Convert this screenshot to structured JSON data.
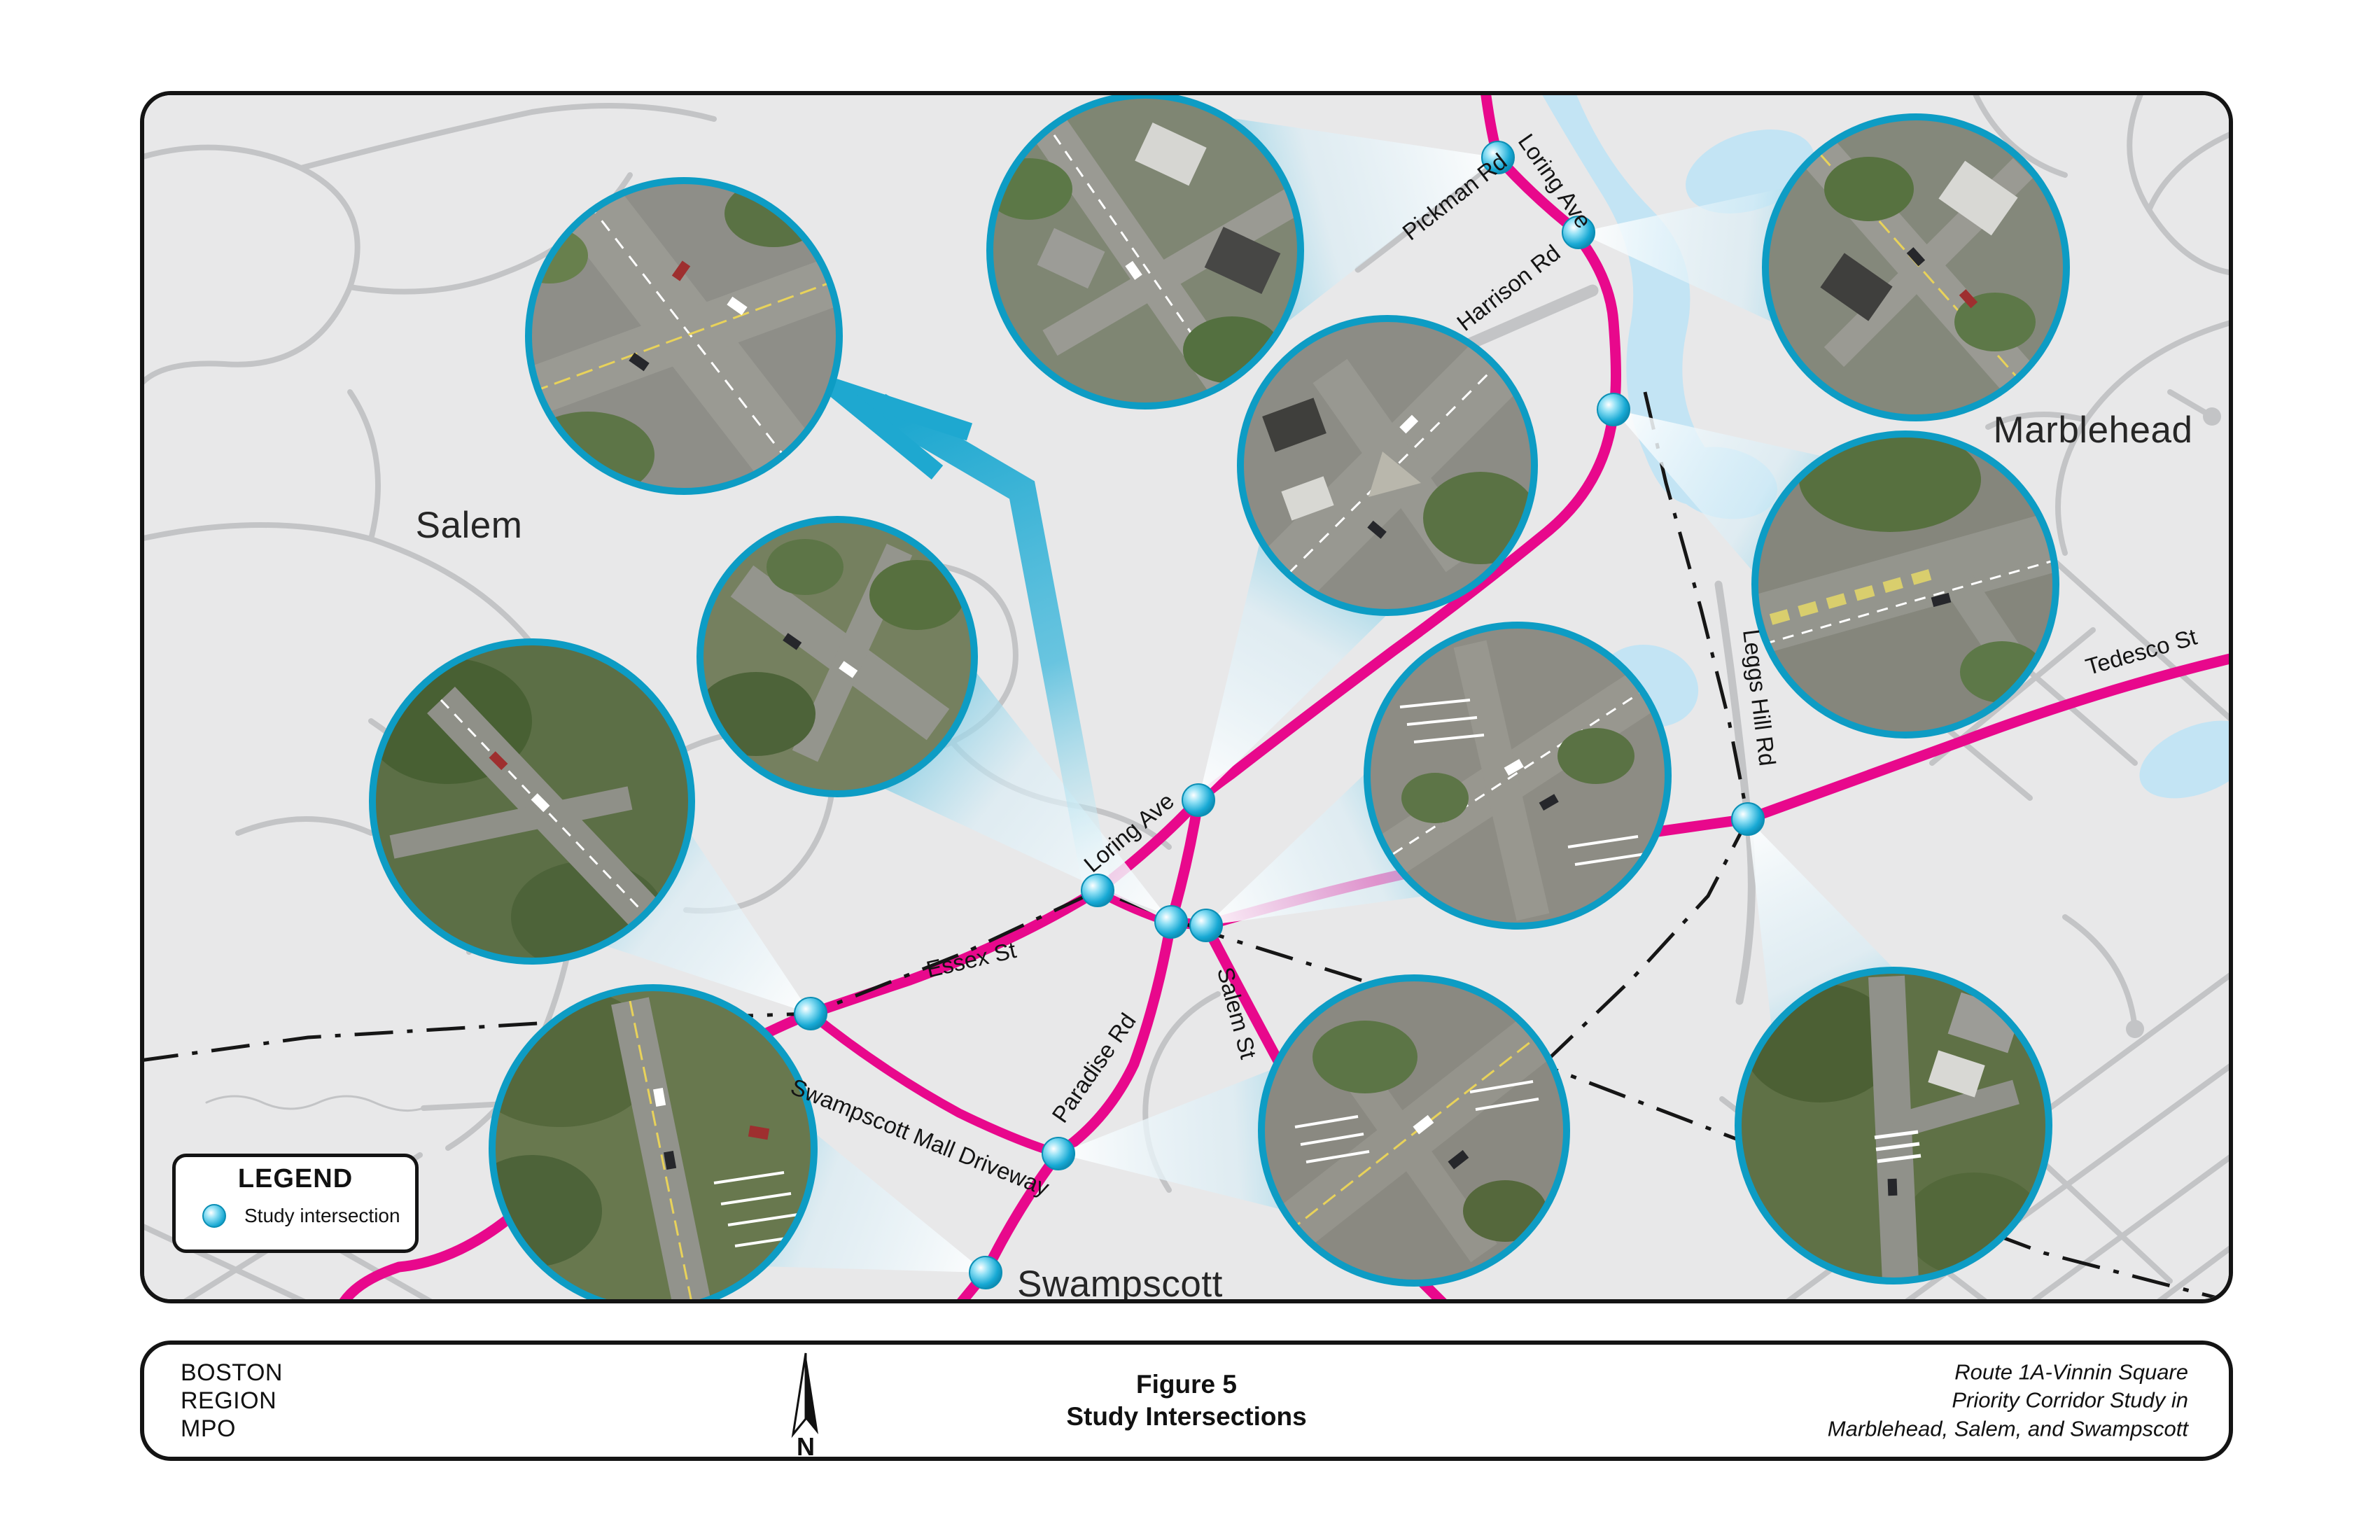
{
  "map": {
    "towns": {
      "salem": "Salem",
      "marblehead": "Marblehead",
      "swampscott": "Swampscott"
    },
    "road_labels": [
      {
        "text": "Pickman Rd"
      },
      {
        "text": "Loring Ave"
      },
      {
        "text": "Harrison Rd"
      },
      {
        "text": "Loring  Ave"
      },
      {
        "text": "Essex St"
      },
      {
        "text": "Salem St"
      },
      {
        "text": "Paradise Rd"
      },
      {
        "text": "Swampscott Mall Driveway"
      },
      {
        "text": "Tedesco St"
      },
      {
        "text": "Leggs Hill Rd"
      }
    ],
    "legend": {
      "title": "LEGEND",
      "items": [
        {
          "label": "Study intersection"
        }
      ]
    },
    "colors": {
      "corridor_pink": "#e8088c",
      "beam_cyan": "#1ea8d0",
      "study_dot": "#17a9d4",
      "water": "#c3e4f4",
      "road_gray": "#c3c4c6",
      "background": "#e8e8e9"
    }
  },
  "footer": {
    "agency_lines": [
      "BOSTON",
      "REGION",
      "MPO"
    ],
    "north_label": "N",
    "figure_line1": "Figure 5",
    "figure_line2": "Study Intersections",
    "project_lines": [
      "Route 1A-Vinnin Square",
      "Priority Corridor Study in",
      "Marblehead, Salem, and Swampscott"
    ]
  }
}
